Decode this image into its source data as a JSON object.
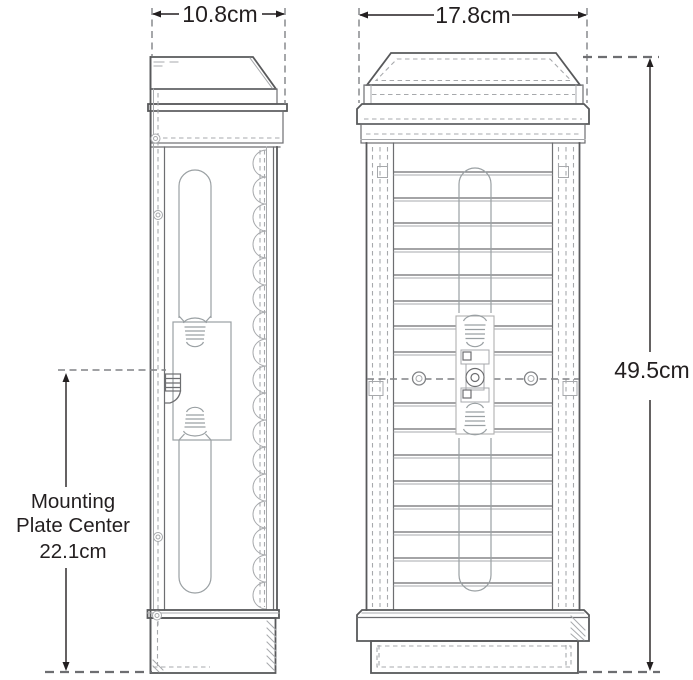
{
  "page": {
    "background_color": "#ffffff",
    "description": "Dimensional line drawing of a wall-mounted lantern sconce, side and front elevations"
  },
  "views": [
    {
      "name": "side-elevation"
    },
    {
      "name": "front-elevation"
    }
  ],
  "dimensions": {
    "side_width": {
      "label": "10.8cm"
    },
    "front_width": {
      "label": "17.8cm"
    },
    "overall_height": {
      "label": "49.5cm"
    },
    "mounting_plate_center": {
      "line1": "Mounting",
      "line2": "Plate Center",
      "line3": "22.1cm"
    }
  },
  "colors": {
    "outline": "#58595b",
    "line": "#6d6e71",
    "light_line": "#a7a9ac",
    "dashed": "#808285",
    "text": "#231f20"
  }
}
